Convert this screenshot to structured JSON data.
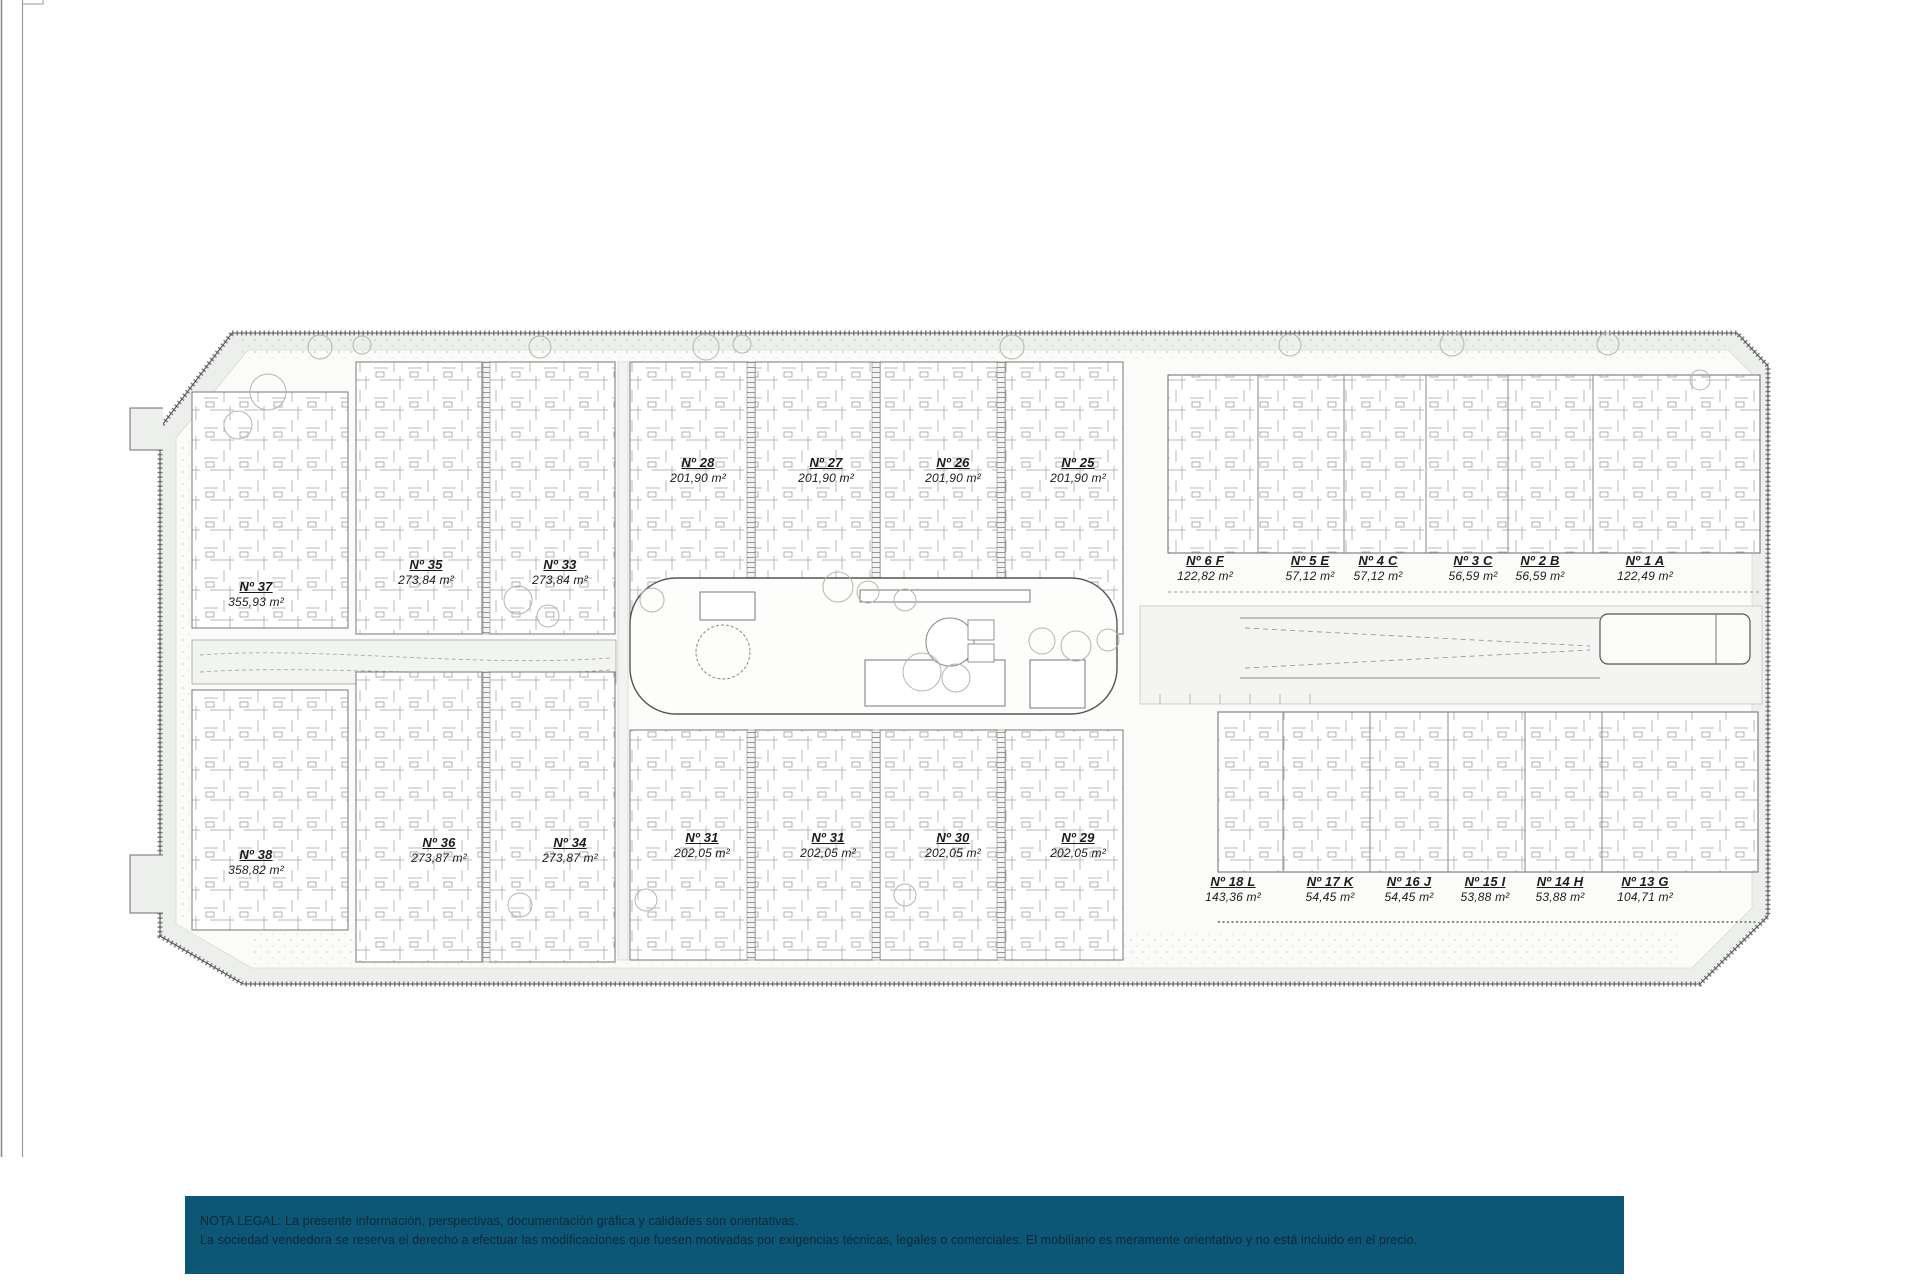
{
  "plan": {
    "groups": [
      {
        "name": "villas-top-left",
        "units": [
          {
            "no": "Nº 37",
            "area": "355,93 m²"
          },
          {
            "no": "Nº 35",
            "area": "273,84 m²"
          },
          {
            "no": "Nº 33",
            "area": "273,84 m²"
          }
        ]
      },
      {
        "name": "row-top-middle",
        "units": [
          {
            "no": "Nº 28",
            "area": "201,90 m²"
          },
          {
            "no": "Nº 27",
            "area": "201,90 m²"
          },
          {
            "no": "Nº 26",
            "area": "201,90 m²"
          },
          {
            "no": "Nº 25",
            "area": "201,90 m²"
          }
        ]
      },
      {
        "name": "apartments-top-right",
        "units": [
          {
            "no": "Nº 6 F",
            "area": "122,82 m²"
          },
          {
            "no": "Nº 5 E",
            "area": "57,12 m²"
          },
          {
            "no": "Nº 4 C",
            "area": "57,12 m²"
          },
          {
            "no": "Nº 3 C",
            "area": "56,59 m²"
          },
          {
            "no": "Nº 2 B",
            "area": "56,59 m²"
          },
          {
            "no": "Nº 1 A",
            "area": "122,49 m²"
          }
        ]
      },
      {
        "name": "villas-bottom-left",
        "units": [
          {
            "no": "Nº 38",
            "area": "358,82 m²"
          },
          {
            "no": "Nº 36",
            "area": "273,87 m²"
          },
          {
            "no": "Nº 34",
            "area": "273,87 m²"
          }
        ]
      },
      {
        "name": "row-bottom-middle",
        "units": [
          {
            "no": "Nº 31",
            "area": "202,05 m²"
          },
          {
            "no": "Nº 31",
            "area": "202,05 m²"
          },
          {
            "no": "Nº 30",
            "area": "202,05 m²"
          },
          {
            "no": "Nº 29",
            "area": "202,05 m²"
          }
        ]
      },
      {
        "name": "apartments-bottom-right",
        "units": [
          {
            "no": "Nº 18 L",
            "area": "143,36 m²"
          },
          {
            "no": "Nº 17 K",
            "area": "54,45 m²"
          },
          {
            "no": "Nº 16 J",
            "area": "54,45 m²"
          },
          {
            "no": "Nº 15 I",
            "area": "53,88 m²"
          },
          {
            "no": "Nº 14 H",
            "area": "53,88 m²"
          },
          {
            "no": "Nº 13 G",
            "area": "104,71 m²"
          }
        ]
      }
    ]
  },
  "legal_notice": {
    "bg_color": "#0d5776",
    "text_color": "#0b2836",
    "line1": "NOTA LEGAL: La presente información, perspectivas, documentación gráfica y calidades son orientativas.",
    "line2": "La sociedad vendedora se reserva el derecho a efectuar las modificaciones que fuesen motivadas por exigencias técnicas, legales o comerciales. El mobiliario es meramente orientativo y no está incluido en el precio."
  }
}
